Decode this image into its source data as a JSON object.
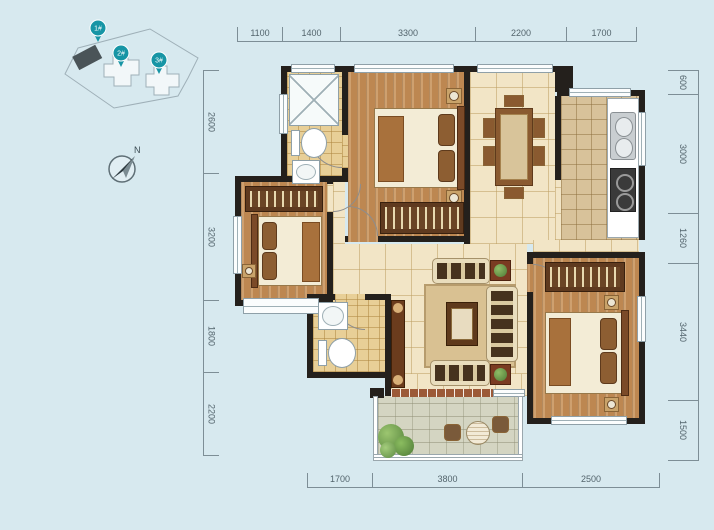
{
  "canvas": {
    "background": "#d7e9ef"
  },
  "site_plan": {
    "markers": [
      {
        "label": "1#"
      },
      {
        "label": "2#"
      },
      {
        "label": "3#"
      }
    ]
  },
  "compass": {
    "label": "N"
  },
  "dimensions": {
    "top": [
      "1100",
      "1400",
      "3300",
      "2200",
      "1700"
    ],
    "left": [
      "2600",
      "3200",
      "1800",
      "2200"
    ],
    "right": [
      "600",
      "3000",
      "1260",
      "3440",
      "1500"
    ],
    "bottom": [
      "1700",
      "3800",
      "2500"
    ]
  },
  "colors": {
    "background": "#d7e9ef",
    "wall": "#24201c",
    "wood_floor": "#bd8751",
    "cream_tile": "#f2e5c6",
    "bath_tile": "#e8cf97",
    "kitchen_tile": "#d8c29a",
    "balcony_stone": "#d4d5c2",
    "marker_teal": "#1795a5",
    "dimension_text": "#53646c"
  },
  "icons": {
    "building-pin-icon": "teal balloon circle with tail",
    "north-arrow-icon": "dark NE-pointing needle in circle",
    "shower-icon": "square with X cross lines",
    "toilet-icon": "tank rectangle + oval bowl",
    "sink-icon": "square with round basin",
    "bed-icon": "mattress with headboard and two pillows",
    "wardrobe-icon": "dark cabinet with hanger stripes",
    "dining-table-icon": "rectangle table with six chairs",
    "kitchen-sink-icon": "steel counter with two ovals",
    "stove-icon": "dark hob with two burners",
    "sofa-icon": "cream seat with dark cushions",
    "coffee-table-icon": "dark rectangle with tray",
    "plant-icon": "square planter with green foliage",
    "balcony-table-icon": "round table with two chairs",
    "door-arc-icon": "quarter-circle swing arc"
  }
}
